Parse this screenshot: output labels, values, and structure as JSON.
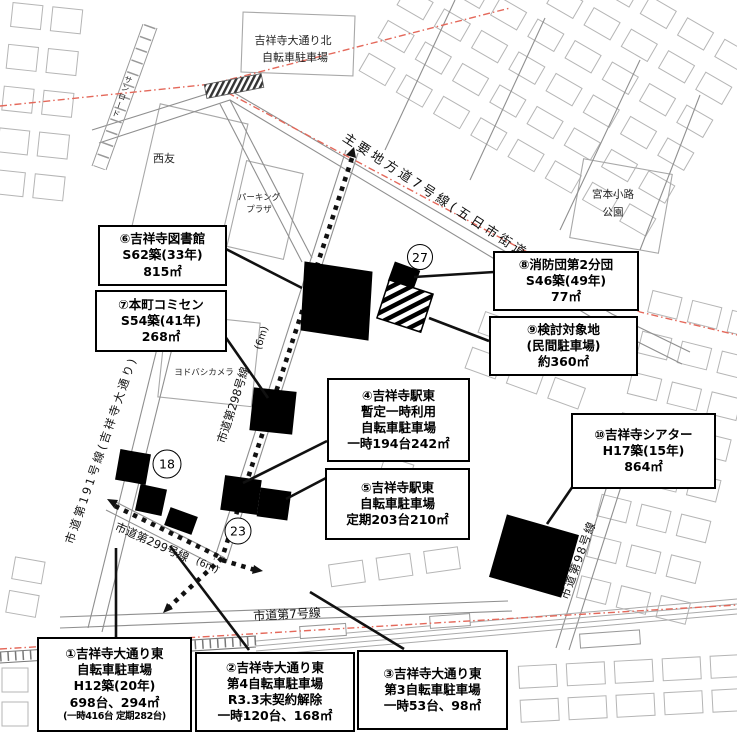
{
  "map": {
    "area_labels": {
      "north_parking_line1": "吉祥寺大通り北",
      "north_parking_line2": "自転車駐車場",
      "seiyu": "西友",
      "parking_plaza_line1": "パーキング",
      "parking_plaza_line2": "プラザ",
      "miyamoto_line1": "宮本小路",
      "miyamoto_line2": "公園",
      "yodobashi": "ヨドバシカメラ",
      "sunroad": "サンロード"
    },
    "road_labels": {
      "main_road": "主要地方道7号線(五日市街道)",
      "road_298": "市道第298号線",
      "road_191": "市道第191号線(吉祥寺大通り)",
      "road_299": "市道第299号線",
      "road_7": "市道第7号線",
      "road_98": "市道第98号線",
      "width_6m_a": "(6m)",
      "width_6m_b": "(6m)"
    },
    "circled_numbers": {
      "n27": "27",
      "n18": "18",
      "n23": "23"
    }
  },
  "callouts": {
    "c1": {
      "lines": [
        "①吉祥寺大通り東",
        "自転車駐車場",
        "H12築(20年)",
        "698台、294㎡",
        "(一時416台 定期282台)"
      ]
    },
    "c2": {
      "lines": [
        "②吉祥寺大通り東",
        "第4自転車駐車場",
        "R3.3末契約解除",
        "一時120台、168㎡"
      ]
    },
    "c3": {
      "lines": [
        "③吉祥寺大通り東",
        "第3自転車駐車場",
        "一時53台、98㎡"
      ]
    },
    "c4": {
      "lines": [
        "④吉祥寺駅東",
        "暫定一時利用",
        "自転車駐車場",
        "一時194台242㎡"
      ]
    },
    "c5": {
      "lines": [
        "⑤吉祥寺駅東",
        "自転車駐車場",
        "定期203台210㎡"
      ]
    },
    "c6": {
      "lines": [
        "⑥吉祥寺図書館",
        "S62築(33年)",
        "815㎡"
      ]
    },
    "c7": {
      "lines": [
        "⑦本町コミセン",
        "S54築(41年)",
        "268㎡"
      ]
    },
    "c8": {
      "lines": [
        "⑧消防団第2分団",
        "S46築(49年)",
        "77㎡"
      ]
    },
    "c9": {
      "lines": [
        "⑨検討対象地",
        "(民間駐車場)",
        "約360㎡"
      ]
    },
    "c10": {
      "lines": [
        "⑩吉祥寺シアター",
        "H17築(15年)",
        "864㎡"
      ]
    }
  },
  "colors": {
    "boundary_red": "#e4685a",
    "building_black": "#000000",
    "street_gray": "#8f8f8f",
    "block_outline_gray": "#b5b5b5"
  }
}
